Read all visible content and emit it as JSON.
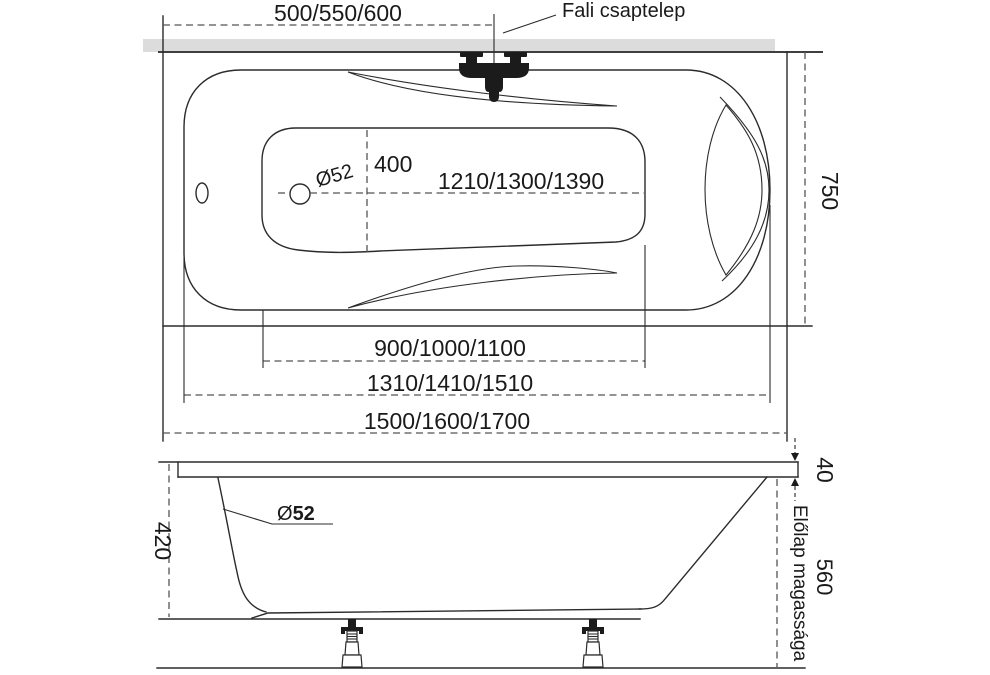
{
  "top_view": {
    "wall_faucet_label": "Fali csaptelep",
    "dims": {
      "faucet_position": "500/550/600",
      "width": "750",
      "drain_to_end": "1210/1300/1390",
      "drain_offset": "400",
      "drain_diameter": "Ø52",
      "floor_length": "900/1000/1100",
      "opening_length": "1310/1410/1510",
      "overall_length": "1500/1600/1700"
    }
  },
  "side_view": {
    "front_panel_label": "Előlap magassága",
    "dims": {
      "depth": "420",
      "rim_height": "40",
      "front_panel_height": "560",
      "drain_symbol": "Ø",
      "drain_value": "52"
    }
  },
  "colors": {
    "line": "#2b2b2b",
    "dash_line": "#545454",
    "wall_band": "#dcdcdc",
    "wall_edge": "#3f3f3f",
    "solid_black": "#1b1b1b",
    "background": "#ffffff"
  }
}
